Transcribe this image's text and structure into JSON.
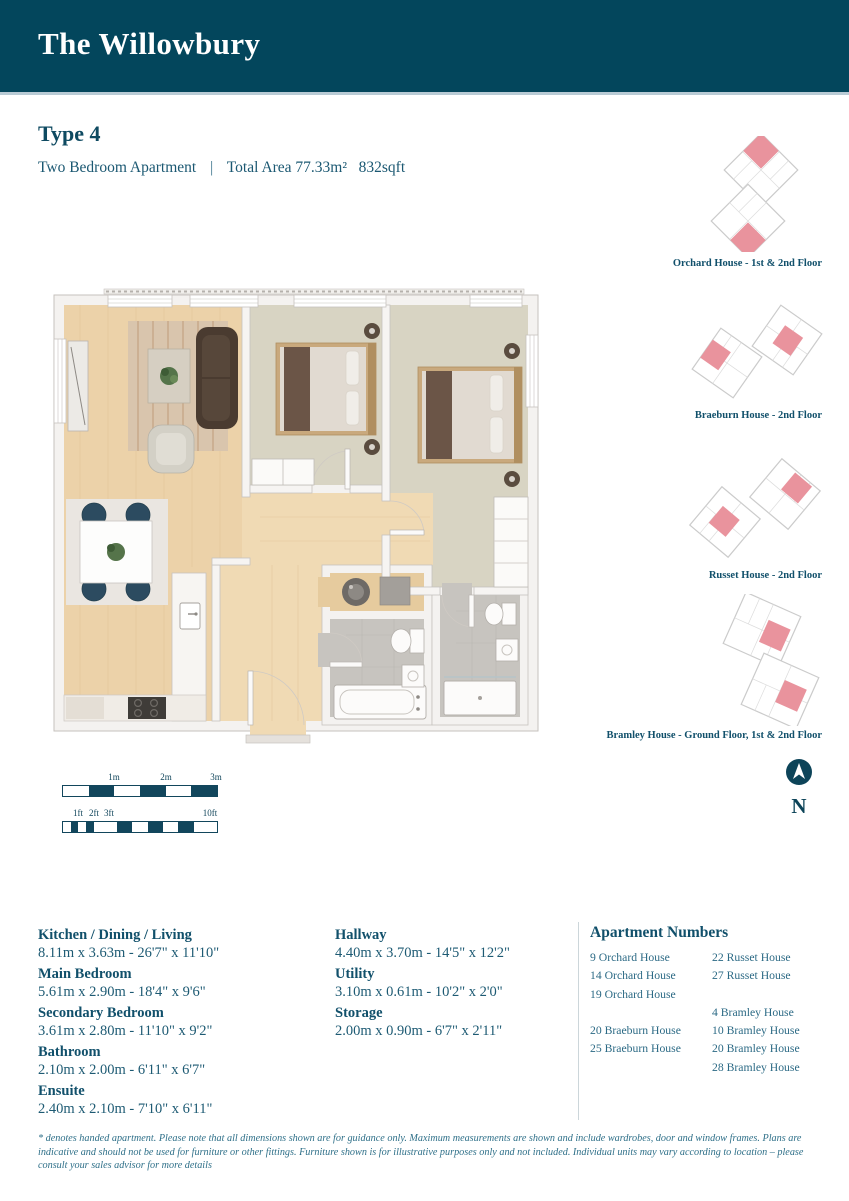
{
  "header": {
    "title": "The Willowbury"
  },
  "overview": {
    "type": "Type 4",
    "category": "Two Bedroom Apartment",
    "separator": "|",
    "area": "Total Area 77.33m²",
    "sqft": "832sqft"
  },
  "locators": [
    {
      "label": "Orchard House - 1st & 2nd Floor"
    },
    {
      "label": "Braeburn House - 2nd Floor"
    },
    {
      "label": "Russet House - 2nd Floor"
    },
    {
      "label": "Bramley House -  Ground Floor, 1st & 2nd Floor"
    }
  ],
  "scale": {
    "meters": [
      "1m",
      "2m",
      "3m"
    ],
    "feet": [
      "1ft",
      "2ft",
      "3ft",
      "10ft"
    ]
  },
  "compass": {
    "label": "N"
  },
  "rooms_left": [
    {
      "name": "Kitchen / Dining / Living",
      "dims": "8.11m x 3.63m  -  26'7\" x 11'10\""
    },
    {
      "name": "Main Bedroom",
      "dims": "5.61m x 2.90m  -  18'4\" x 9'6\""
    },
    {
      "name": "Secondary Bedroom",
      "dims": "3.61m x 2.80m  -  11'10\" x 9'2\""
    },
    {
      "name": "Bathroom",
      "dims": "2.10m x 2.00m  -  6'11\" x 6'7\""
    },
    {
      "name": "Ensuite",
      "dims": "2.40m x 2.10m  -  7'10\" x 6'11\""
    }
  ],
  "rooms_middle": [
    {
      "name": "Hallway",
      "dims": "4.40m x 3.70m  -  14'5\" x 12'2\""
    },
    {
      "name": "Utility",
      "dims": "3.10m x 0.61m  -  10'2\" x 2'0\""
    },
    {
      "name": "Storage",
      "dims": "2.00m x 0.90m  -  6'7\" x 2'11\""
    }
  ],
  "apartment_numbers": {
    "heading": "Apartment Numbers",
    "col1": [
      "9 Orchard House",
      "14 Orchard House",
      "19 Orchard House",
      "",
      "20 Braeburn House",
      "25 Braeburn House",
      ""
    ],
    "col2": [
      "22 Russet House",
      "27 Russet House",
      "",
      "4 Bramley House",
      "10 Bramley House",
      "20 Bramley House",
      "28 Bramley House"
    ]
  },
  "footer": {
    "disclaimer": "* denotes handed apartment. Please note that all dimensions shown are for guidance only. Maximum measurements are shown and include wardrobes, door and window frames. Plans are indicative and should not be used for furniture or other fittings. Furniture shown is for illustrative purposes only and not included. Individual units may vary according to location – please consult your sales advisor for more details"
  },
  "colors": {
    "header_bg": "#03465c",
    "title_text": "#ffffff",
    "heading_text": "#11506b",
    "body_text": "#1d5a73",
    "list_text": "#2c6a85",
    "footer_text": "#2f7089",
    "highlight_pink": "#e9939d",
    "diagram_outline": "#cbcbcb",
    "scale_dark": "#12465c",
    "wood_floor": "#ecd2a9",
    "carpet": "#d8d4c3",
    "tile": "#c7c4bf"
  }
}
